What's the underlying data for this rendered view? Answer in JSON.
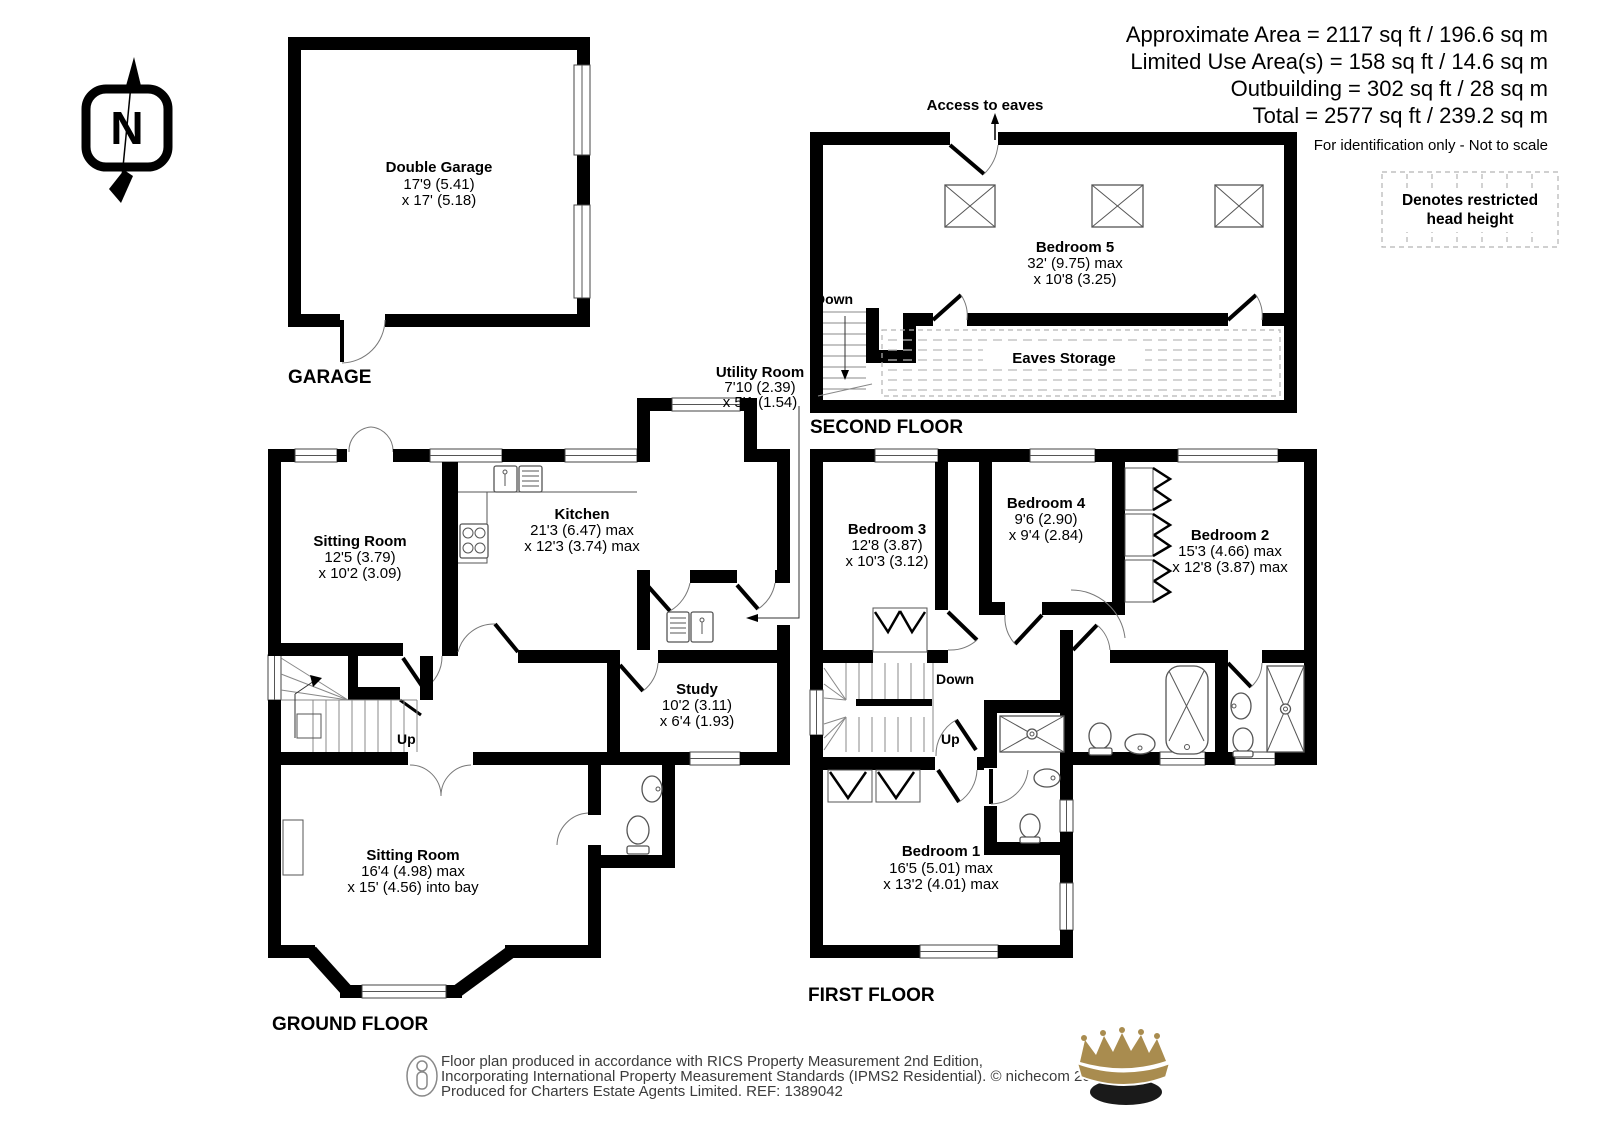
{
  "header": {
    "line1": "Approximate Area = 2117 sq ft / 196.6 sq m",
    "line2": "Limited Use Area(s) = 158 sq ft / 14.6 sq m",
    "line3": "Outbuilding = 302 sq ft / 28 sq m",
    "line4": "Total = 2577 sq ft / 239.2 sq m",
    "disclaimer": "For identification only - Not to scale"
  },
  "legend": {
    "line1": "Denotes restricted",
    "line2": "head height"
  },
  "compass": {
    "letter": "N"
  },
  "garage": {
    "label": "GARAGE",
    "room": {
      "name": "Double Garage",
      "dim1": "17'9 (5.41)",
      "dim2": "x 17' (5.18)"
    }
  },
  "second_floor": {
    "label": "SECOND FLOOR",
    "access": "Access to eaves",
    "down": "Down",
    "eaves": "Eaves Storage",
    "bedroom5": {
      "name": "Bedroom 5",
      "dim1": "32' (9.75) max",
      "dim2": "x 10'8 (3.25)"
    }
  },
  "ground_floor": {
    "label": "GROUND FLOOR",
    "up": "Up",
    "sitting1": {
      "name": "Sitting Room",
      "dim1": "12'5 (3.79)",
      "dim2": "x 10'2 (3.09)"
    },
    "kitchen": {
      "name": "Kitchen",
      "dim1": "21'3 (6.47) max",
      "dim2": "x 12'3 (3.74) max"
    },
    "utility": {
      "name": "Utility Room",
      "dim1": "7'10 (2.39)",
      "dim2": "x 5'1 (1.54)"
    },
    "study": {
      "name": "Study",
      "dim1": "10'2 (3.11)",
      "dim2": "x 6'4 (1.93)"
    },
    "sitting2": {
      "name": "Sitting Room",
      "dim1": "16'4 (4.98) max",
      "dim2": "x 15' (4.56) into bay"
    }
  },
  "first_floor": {
    "label": "FIRST FLOOR",
    "down": "Down",
    "up": "Up",
    "bedroom1": {
      "name": "Bedroom 1",
      "dim1": "16'5 (5.01) max",
      "dim2": "x 13'2 (4.01) max"
    },
    "bedroom2": {
      "name": "Bedroom 2",
      "dim1": "15'3 (4.66) max",
      "dim2": "x 12'8 (3.87) max"
    },
    "bedroom3": {
      "name": "Bedroom 3",
      "dim1": "12'8 (3.87)",
      "dim2": "x 10'3 (3.12)"
    },
    "bedroom4": {
      "name": "Bedroom 4",
      "dim1": "9'6 (2.90)",
      "dim2": "x 9'4 (2.84)"
    }
  },
  "footer": {
    "line1": "Floor plan produced in accordance with RICS Property Measurement 2nd Edition,",
    "line2": "Incorporating International Property Measurement Standards (IPMS2 Residential).   © nichecom 2025.",
    "line3": "Produced for Charters Estate Agents Limited.   REF: 1389042"
  },
  "colors": {
    "wall": "#000000",
    "crown_gold": "#a98c4f",
    "fixture": "#555555"
  }
}
